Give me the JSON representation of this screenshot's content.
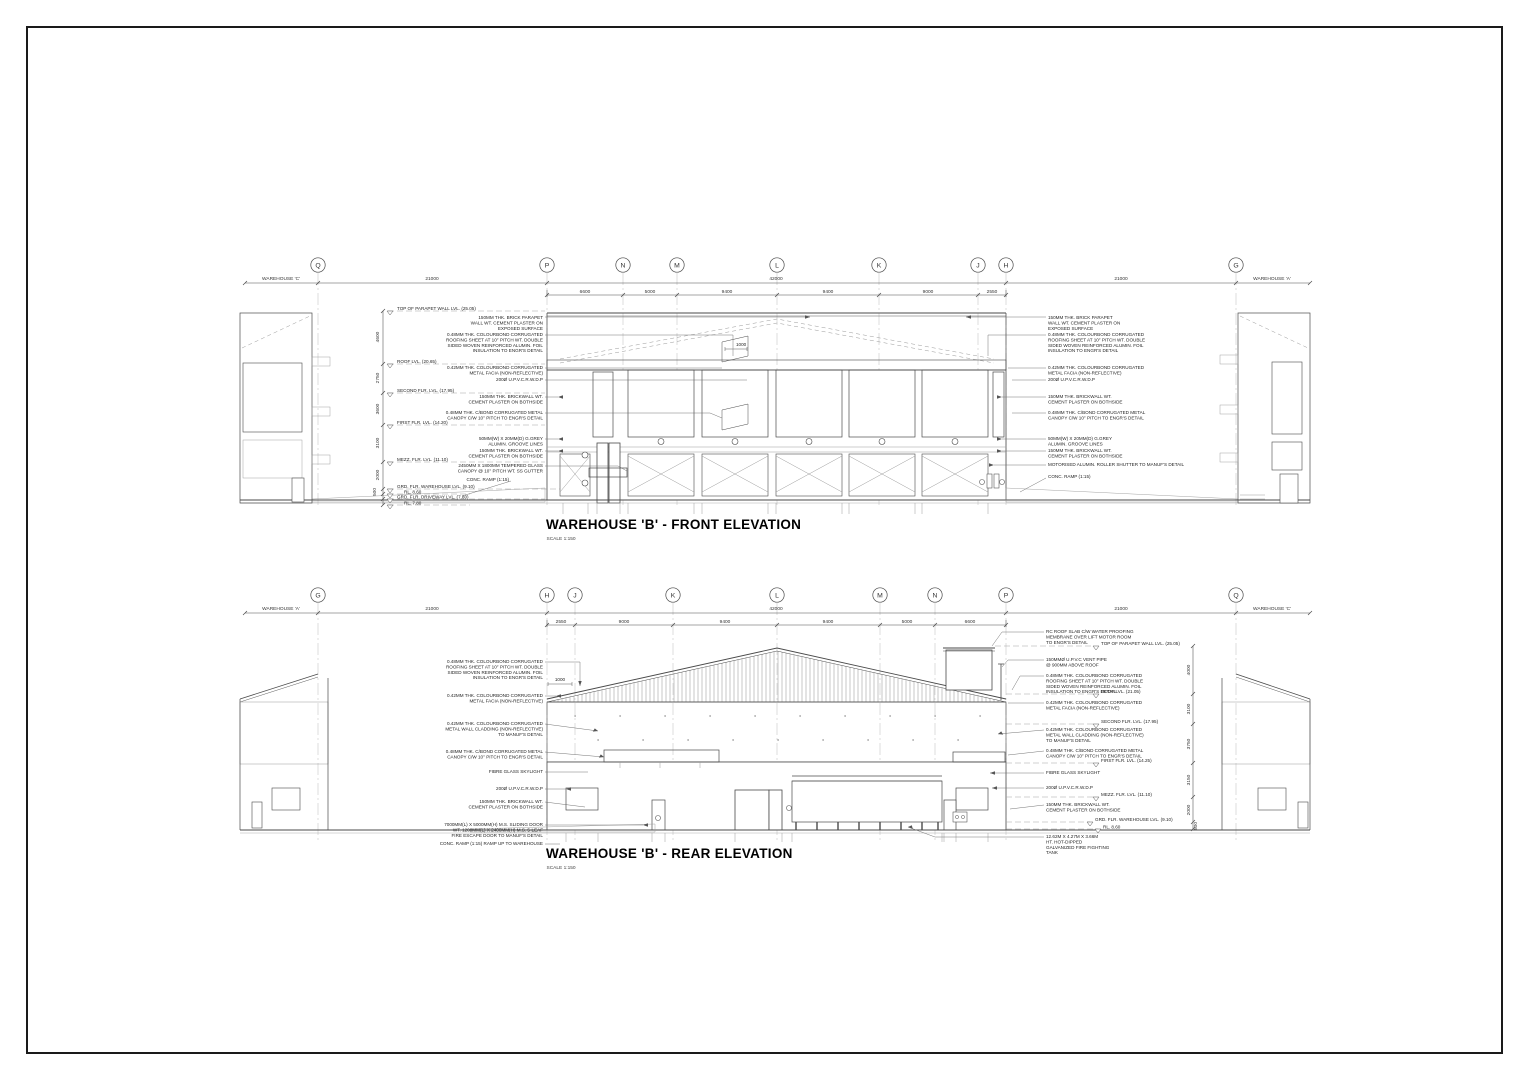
{
  "colors": {
    "paper": "#ffffff",
    "ink": "#1f1f1f",
    "line": "#4a4a4a",
    "light_line": "#9a9a9a"
  },
  "drawing": {
    "front": {
      "title": "WAREHOUSE 'B' - FRONT ELEVATION",
      "scale": "SCALE 1:150",
      "context_left": "WAREHOUSE 'C'",
      "context_right": "WAREHOUSE 'A'",
      "grid": [
        "Q",
        "P",
        "N",
        "M",
        "L",
        "K",
        "J",
        "H",
        "G"
      ],
      "dims_top": [
        "21000",
        "42000",
        "21000"
      ],
      "dims_bays": [
        "6600",
        "5000",
        "9400",
        "9400",
        "9000",
        "2550"
      ],
      "dims_vert": [
        "4600",
        "2750",
        "3600",
        "3100",
        "2000",
        "500"
      ],
      "dim_small": "1000",
      "levels": [
        "TOP OF PARAPET WALL LVL. (25.05)",
        "ROOF LVL. (20.65)",
        "SECOND FLR. LVL. (17.95)",
        "FIRST FLR. LVL. (14.20)",
        "MEZZ. FLR. LVL. (11.10)",
        "GRD. FLR. WAREHOUSE LVL. (9.10)",
        "RL. 8.60",
        "GRD. FLR. DRIVEWAY LVL. (7.80)",
        "RL. 7.80"
      ],
      "notes_left": [
        [
          "150MM THK. BRICK PARAPET",
          "WALL WT. CEMENT PLASTER ON",
          "EXPOSED SURFACE"
        ],
        [
          "0.48MM THK. COLOURBOND CORRUGATED",
          "ROOFING SHEET AT 10° PITCH WT. DOUBLE",
          "SIDED WOVEN REINFORCED ALUMIN. FOIL",
          "INSULATION TO ENGR'S DETAIL"
        ],
        [
          "0.42MM THK. COLOURBOND CORRUGATED",
          "METAL FACIA (NON-REFLECTIVE)"
        ],
        [
          "200Ø U.P.V.C.R.W.D.P"
        ],
        [
          "150MM THK. BRICKWALL WT.",
          "CEMENT PLASTER ON BOTHSIDE"
        ],
        [
          "0.48MM THK. C/BOND CORRUGATED METAL",
          "CANOPY C/W 10° PITCH TO ENGR'S DETAIL"
        ],
        [
          "50MM(W) X 20MM(D) G.GREY",
          "ALUMIN. GROOVE LINES"
        ],
        [
          "150MM THK. BRICKWALL WT.",
          "CEMENT PLASTER ON BOTHSIDE"
        ],
        [
          "2450MM X 1800MM TEMPERED GLASS",
          "CANOPY @ 10° PITCH WT. SS GUTTER"
        ],
        [
          "CONC. RAMP (1:15)"
        ]
      ],
      "notes_right": [
        [
          "150MM THK. BRICK PARAPET",
          "WALL WT. CEMENT PLASTER ON",
          "EXPOSED SURFACE"
        ],
        [
          "0.48MM THK. COLOURBOND CORRUGATED",
          "ROOFING SHEET AT 10° PITCH WT. DOUBLE",
          "SIDED WOVEN REINFORCED ALUMIN. FOIL",
          "INSULATION TO ENGR'S DETAIL"
        ],
        [
          "0.42MM THK. COLOURBOND CORRUGATED",
          "METAL FACIA (NON-REFLECTIVE)"
        ],
        [
          "200Ø U.P.V.C.R.W.D.P"
        ],
        [
          "150MM THK. BRICKWALL WT.",
          "CEMENT PLASTER ON BOTHSIDE"
        ],
        [
          "0.48MM THK. C/BOND CORRUGATED METAL",
          "CANOPY C/W 10° PITCH TO ENGR'S DETAIL"
        ],
        [
          "50MM(W) X 20MM(D) G.GREY",
          "ALUMIN. GROOVE LINES"
        ],
        [
          "150MM THK. BRICKWALL WT.",
          "CEMENT PLASTER ON BOTHSIDE"
        ],
        [
          "MOTORISED ALUMIN. ROLLER SHUTTER TO MANUF'S DETAIL"
        ],
        [
          "CONC. RAMP (1:15)"
        ]
      ]
    },
    "rear": {
      "title": "WAREHOUSE 'B' - REAR ELEVATION",
      "scale": "SCALE 1:150",
      "context_left": "WAREHOUSE 'A'",
      "context_right": "WAREHOUSE 'C'",
      "grid": [
        "G",
        "H",
        "J",
        "K",
        "L",
        "M",
        "N",
        "P",
        "Q"
      ],
      "dims_top": [
        "21000",
        "42000",
        "21000"
      ],
      "dims_bays": [
        "2550",
        "9000",
        "9400",
        "9400",
        "5000",
        "6600"
      ],
      "dims_vert": [
        "4000",
        "3100",
        "3750",
        "3150",
        "2000",
        "500"
      ],
      "dim_small": "1000",
      "levels": [
        "TOP OF PARAPET WALL LVL. (25.05)",
        "ROOF LVL. (21.05)",
        "SECOND FLR. LVL. (17.95)",
        "FIRST FLR. LVL. (14.25)",
        "MEZZ. FLR. LVL. (11.10)",
        "GRD. FLR. WAREHOUSE LVL. (9.10)",
        "RL. 8.60"
      ],
      "notes_left": [
        [
          "0.48MM THK. COLOURBOND CORRUGATED",
          "ROOFING SHEET AT 10° PITCH WT. DOUBLE",
          "SIDED WOVEN REINFORCED ALUMIN. FOIL",
          "INSULATION TO ENGR'S DETAIL"
        ],
        [
          "0.42MM THK. COLOURBOND CORRUGATED",
          "METAL FACIA (NON-REFLECTIVE)"
        ],
        [
          "0.42MM THK. COLOURBOND CORRUGATED",
          "METAL WALL CLADDING (NON-REFLECTIVE)",
          "TO MANUF'S DETAIL"
        ],
        [
          "0.48MM THK. C/BOND CORRUGATED METAL",
          "CANOPY C/W 10° PITCH TO ENGR'S DETAIL"
        ],
        [
          "FIBRE GLASS SKYLIGHT"
        ],
        [
          "200Ø U.P.V.C.R.W.D.P"
        ],
        [
          "150MM THK. BRICKWALL WT.",
          "CEMENT PLASTER ON BOTHSIDE"
        ],
        [
          "7000MM(L) X 5000MM(H) M.S. SLIDING DOOR",
          "WT. 1200MM(L) X 2400MM(H) M.S. 5-LEAF",
          "FIRE ESCAPE DOOR TO MANUF'S DETAIL"
        ],
        [
          "CONC. RAMP (1:15) RAMP UP TO WAREHOUSE"
        ]
      ],
      "notes_right": [
        [
          "RC ROOF SLAB C/W WATER PROOFING",
          "MEMBRANE OVER LIFT MOTOR ROOM",
          "TO ENGR'S DETAIL"
        ],
        [
          "150MMØ U.P.V.C VENT PIPE",
          "@ 900MM ABOVE ROOF"
        ],
        [
          "0.48MM THK. COLOURBOND CORRUGATED",
          "ROOFING SHEET AT 10° PITCH WT. DOUBLE",
          "SIDED WOVEN REINFORCED ALUMIN. FOIL",
          "INSULATION TO ENGR'S DETAIL"
        ],
        [
          "0.42MM THK. COLOURBOND CORRUGATED",
          "METAL FACIA (NON-REFLECTIVE)"
        ],
        [
          "0.42MM THK. COLOURBOND CORRUGATED",
          "METAL WALL CLADDING (NON-REFLECTIVE)",
          "TO MANUF'S DETAIL"
        ],
        [
          "0.48MM THK. C/BOND CORRUGATED METAL",
          "CANOPY C/W 10° PITCH TO ENGR'S DETAIL"
        ],
        [
          "FIBRE GLASS SKYLIGHT"
        ],
        [
          "200Ø U.P.V.C.R.W.D.P"
        ],
        [
          "150MM THK. BRICKWALL WT.",
          "CEMENT PLASTER ON BOTHSIDE"
        ],
        [
          "12.62M X 4.27M X 3.66M",
          "HT. HOT-DIPPED",
          "GALVANIZED FIRE FIGHTING",
          "TANK"
        ]
      ]
    }
  }
}
